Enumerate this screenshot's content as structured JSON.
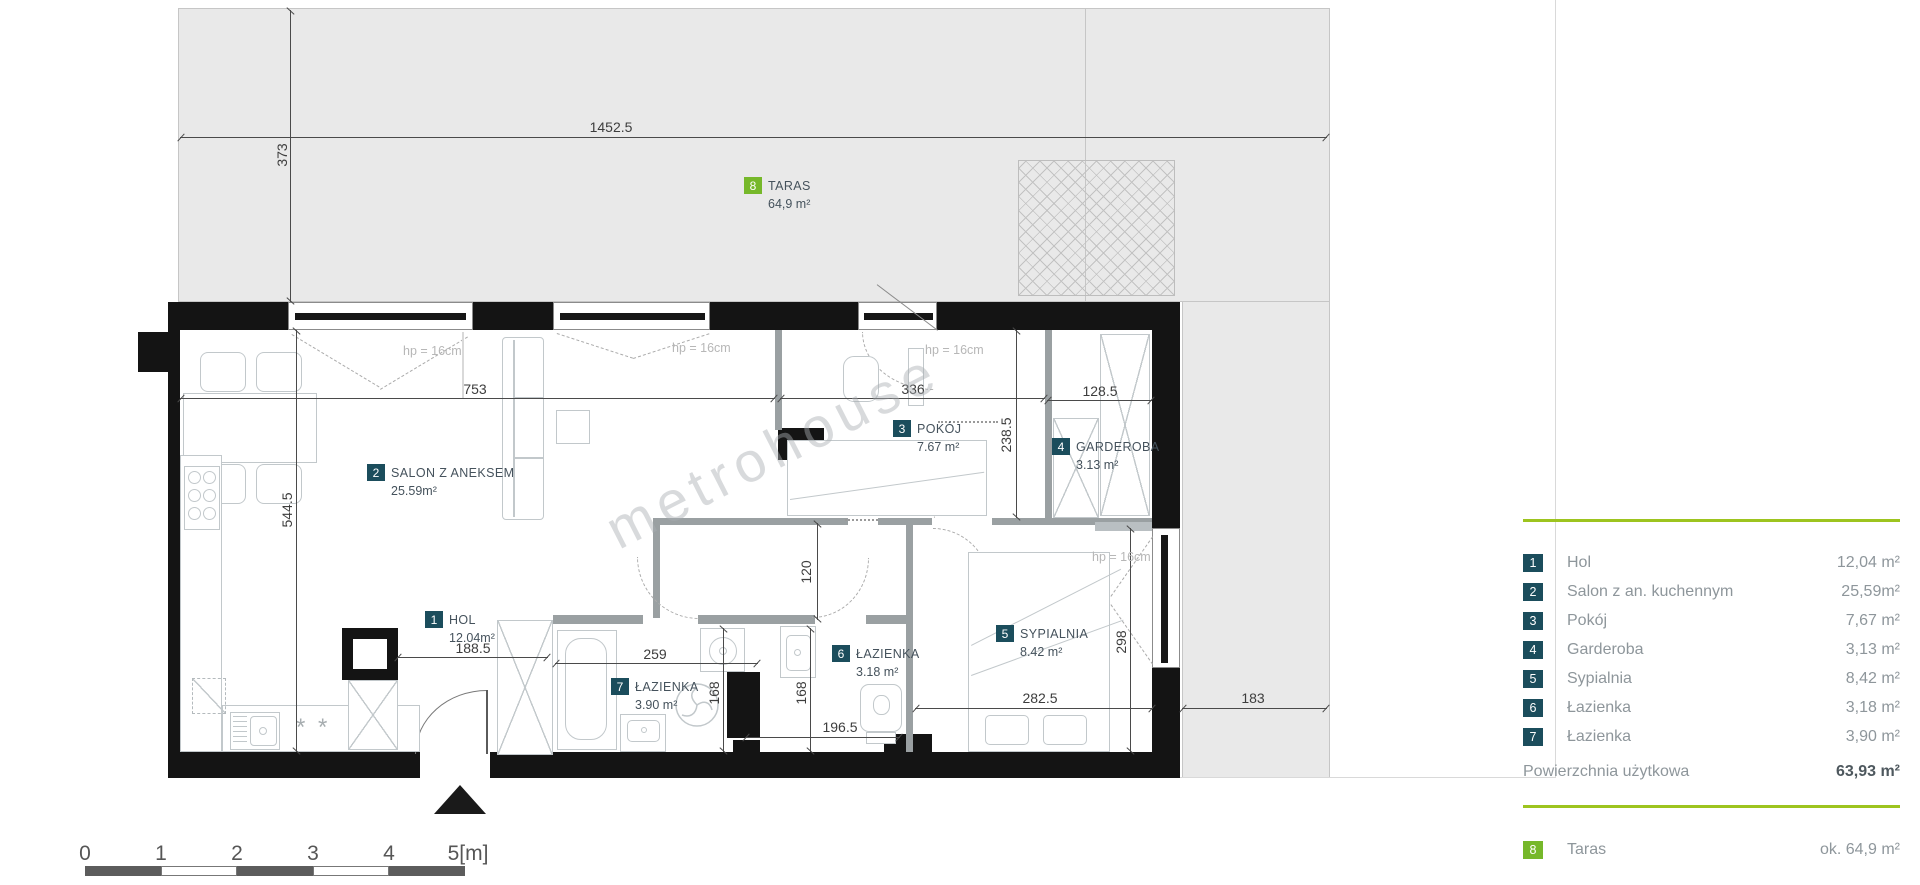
{
  "plan": {
    "watermark": "metrohouse",
    "rooms": [
      {
        "num": "1",
        "name": "HOL",
        "area": "12.04m²"
      },
      {
        "num": "2",
        "name": "SALON Z ANEKSEM",
        "area": "25.59m²"
      },
      {
        "num": "3",
        "name": "POKÓJ",
        "area": "7.67 m²"
      },
      {
        "num": "4",
        "name": "GARDEROBA",
        "area": "3.13 m²"
      },
      {
        "num": "5",
        "name": "SYPIALNIA",
        "area": "8.42 m²"
      },
      {
        "num": "6",
        "name": "ŁAZIENKA",
        "area": "3.18 m²"
      },
      {
        "num": "7",
        "name": "ŁAZIENKA",
        "area": "3.90 m²"
      },
      {
        "num": "8",
        "name": "TARAS",
        "area": "64,9 m²"
      }
    ],
    "dims": [
      "1452.5",
      "373",
      "753",
      "336",
      "128.5",
      "238.5",
      "544.5",
      "188.5",
      "259",
      "168",
      "168",
      "196.5",
      "120",
      "282.5",
      "298",
      "183"
    ],
    "window_height_label": "hp = 16cm",
    "hob_symbol": "* *"
  },
  "legend": {
    "rows": [
      {
        "num": "1",
        "label": "Hol",
        "value": "12,04 m²"
      },
      {
        "num": "2",
        "label": "Salon z an. kuchennym",
        "value": "25,59m²"
      },
      {
        "num": "3",
        "label": "Pokój",
        "value": "7,67 m²"
      },
      {
        "num": "4",
        "label": "Garderoba",
        "value": "3,13 m²"
      },
      {
        "num": "5",
        "label": "Sypialnia",
        "value": "8,42 m²"
      },
      {
        "num": "6",
        "label": "Łazienka",
        "value": "3,18 m²"
      },
      {
        "num": "7",
        "label": "Łazienka",
        "value": "3,90 m²"
      }
    ],
    "total_label": "Powierzchnia użytkowa",
    "total_value": "63,93 m²",
    "terrace_row": {
      "num": "8",
      "label": "Taras",
      "value": "ok. 64,9 m²"
    },
    "accent_green": "#9dc41f",
    "box_teal": "#1b4d5c",
    "box_green": "#76b82a"
  },
  "scalebar": {
    "labels": [
      "0",
      "1",
      "2",
      "3",
      "4",
      "5[m]"
    ]
  }
}
